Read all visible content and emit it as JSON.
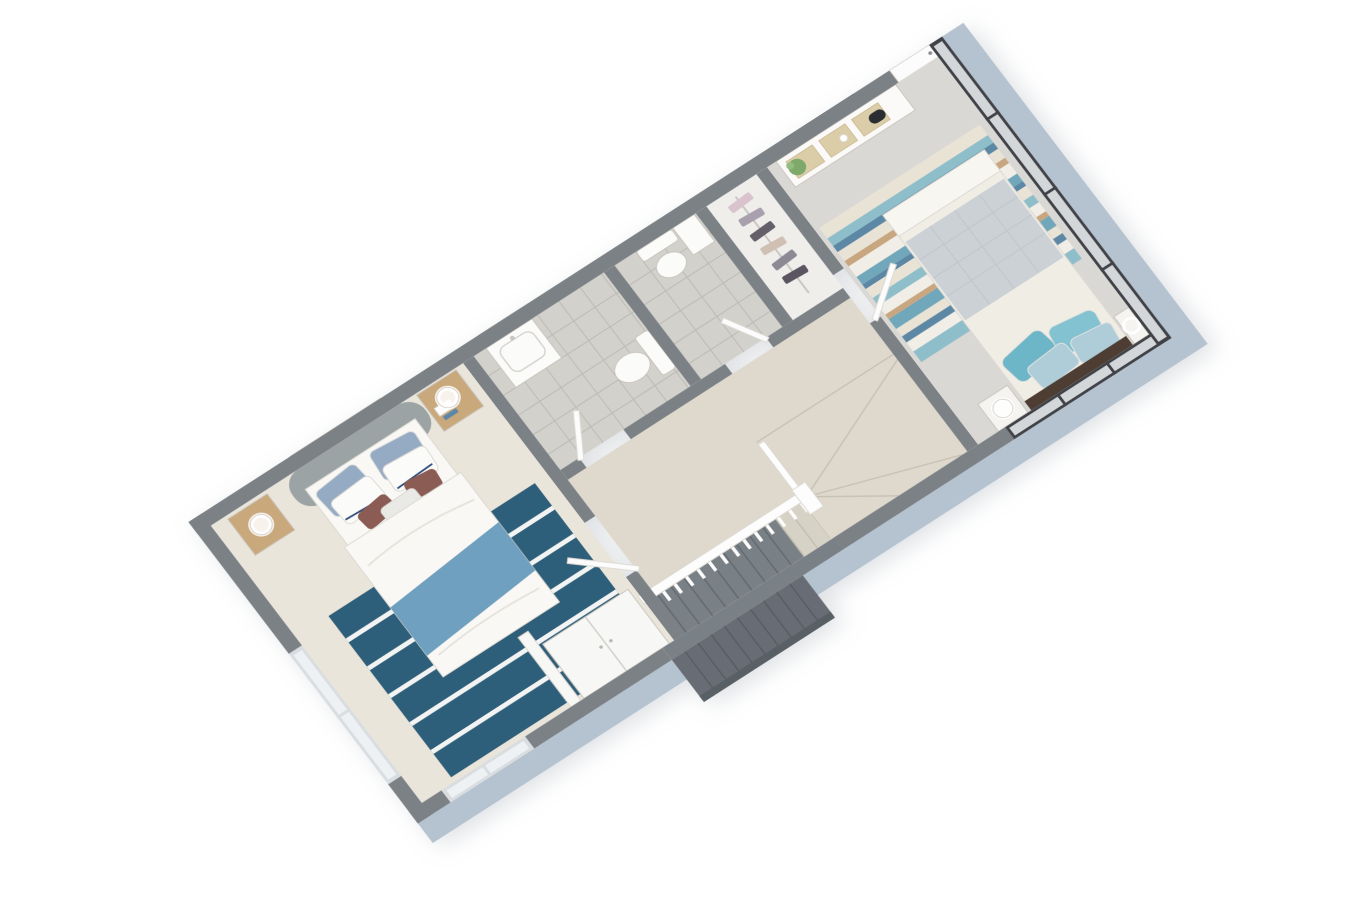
{
  "scene": {
    "type": "3d-floor-plan-render",
    "view": "axonometric-top-down",
    "storey": "upper-floor",
    "background": "#ffffff",
    "rotation_deg": -35
  },
  "palette": {
    "wall": "#7b8186",
    "wall_dark": "#6d7378",
    "slab": "#b5c2cf",
    "glass": "#edf1f3",
    "glass_frame": "#3f4347",
    "window_frame_light": "#d9dde0",
    "carpet_master": "#eae5da",
    "carpet_bedroom2": "#dad8d4",
    "carpet_landing": "#ded9cc",
    "tile": "#d3d1cc",
    "tile_line": "#bcbab5",
    "closet_floor": "#efeeeb",
    "door": "#fcfcfc",
    "rug_master": "#2e5f7a",
    "rug_stripe": "#f2f4f4",
    "headboard_gray": "#9ba3a5",
    "duvet": "#f9f8f5",
    "throw_teal": "#6fa0bf",
    "pillow_bluegray": "#95abc4",
    "pillow_white": "#fbfbfa",
    "pillow_trim_navy": "#2e4d7b",
    "cushion_mauve": "#8a5b52",
    "cushion_light": "#e9e9e5",
    "oak": "#c9a87c",
    "lamp": "#ffffff",
    "art_frame": "#fdfdfc",
    "art_blue": "#5b87a6",
    "art_tan": "#c98f5f",
    "wardrobe": "#f7f7f5",
    "tv": "#16191d",
    "console": "#fbfaf8",
    "rattan": "#dccda9",
    "plant": "#7da96a",
    "decor_dark": "#2a2d31",
    "bedding2": "#f0ede5",
    "sheet2": "#f8f6f1",
    "quilt2": "#ccd1d5",
    "quilt2_line": "#bfc5c9",
    "pillow_teal": "#6db6c8",
    "pillow_teal2": "#83c2d1",
    "pillow_pattern": "#aecdd9",
    "headboard_wood": "#4e3d32",
    "nightstand2": "#f5f4f1",
    "rug2_cream": "#e9e3d6",
    "rug2_white": "#f1eee7",
    "rug2_teal": "#8fbecb",
    "rug2_teal2": "#6fa7ba",
    "rug2_blue": "#5d88a5",
    "rug2_tan": "#c8a67f",
    "stair_upper": "#d7d2c6",
    "stair_lower": "#798086",
    "stair_outer": "#676d74",
    "stair_edge": "#575d64",
    "stair_riser_light": "#c3beb2",
    "balustrade": "#fdfdfd",
    "fixture": "#fbfbfa",
    "mirror": "#dfe9ed",
    "clothes1": "#d9c4cd",
    "clothes2": "#a9a0ad",
    "clothes3": "#655f6b",
    "clothes4": "#cfc0b3",
    "clothes5": "#8d8a96",
    "clothes6": "#5a5461"
  },
  "rooms": [
    {
      "id": "master-bedroom",
      "floor": "beige-carpet"
    },
    {
      "id": "bathroom",
      "floor": "grey-tile"
    },
    {
      "id": "wc",
      "floor": "grey-tile"
    },
    {
      "id": "wardrobe-closet",
      "floor": "light-tile"
    },
    {
      "id": "landing-hall",
      "floor": "beige-carpet"
    },
    {
      "id": "bedroom-2",
      "floor": "grey-carpet"
    }
  ],
  "furniture": {
    "master_bedroom": [
      "double-bed",
      "upholstered-headboard",
      "wall-art",
      "nightstand-left",
      "nightstand-right",
      "ring-lamp-left",
      "ring-lamp-right",
      "striped-area-rug",
      "teal-throw-blanket",
      "built-in-wardrobe",
      "window"
    ],
    "bathroom": [
      "vanity-sink",
      "lit-mirror",
      "toilet"
    ],
    "wc": [
      "toilet",
      "storage-cabinet"
    ],
    "closet": [
      "clothes-rail",
      "hanging-clothes"
    ],
    "landing": [
      "staircase",
      "balustrade-with-spindles"
    ],
    "bedroom_2": [
      "double-bed",
      "wall-mounted-tv",
      "rattan-media-console",
      "potted-plant",
      "striped-rug",
      "nightstand-left",
      "nightstand-right",
      "ring-lamps",
      "glazed-window-wall",
      "reach-in-closet-door"
    ]
  },
  "stairs": {
    "straight_steps": 12,
    "winder_steps": 4,
    "balustrade_spindles": 14,
    "lower_flight_steps": 9
  },
  "windows": {
    "ne_window_wall_panes": 4,
    "se_glass_panes": 3,
    "frame_style": "dark-steel"
  }
}
